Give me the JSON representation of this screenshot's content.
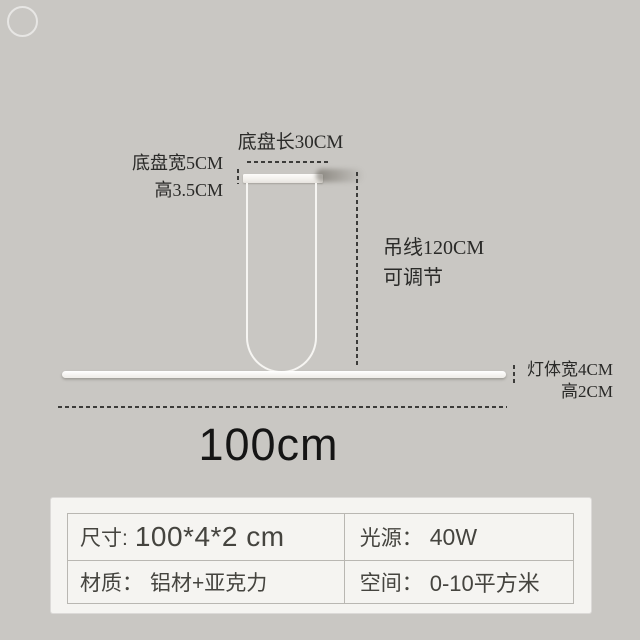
{
  "annotations": {
    "base_length": "底盘长30CM",
    "base_width": "底盘宽5CM",
    "base_height": "高3.5CM",
    "wire_length": "吊线120CM",
    "wire_note": "可调节",
    "body_width": "灯体宽4CM",
    "body_height": "高2CM",
    "total_length": "100cm"
  },
  "spec_table": {
    "rows": [
      [
        {
          "label": "尺寸:",
          "value": "100*4*2 cm"
        },
        {
          "label": "光源：",
          "value": "40W"
        }
      ],
      [
        {
          "label": "材质：",
          "value": "铝材+亚克力"
        },
        {
          "label": "空间：",
          "value": "0-10平方米"
        }
      ]
    ]
  },
  "colors": {
    "background": "#c9c7c3",
    "card_background": "#f5f4f1",
    "table_border": "#b9b7b2",
    "annotation_text": "#2a2a28",
    "table_text": "#45443f",
    "lamp_white": "#f6f5f2"
  }
}
